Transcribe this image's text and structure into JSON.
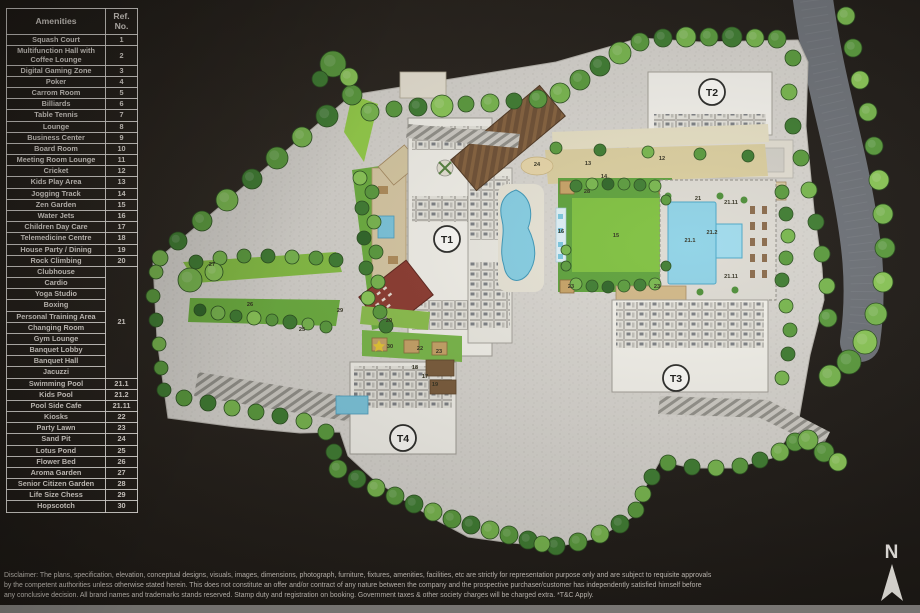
{
  "amenities_table": {
    "headers": [
      "Amenities",
      "Ref. No."
    ],
    "rows": [
      {
        "name": "Squash Court",
        "ref": "1"
      },
      {
        "name": "Multifunction Hall with Coffee Lounge",
        "ref": "2"
      },
      {
        "name": "Digital Gaming Zone",
        "ref": "3"
      },
      {
        "name": "Poker",
        "ref": "4"
      },
      {
        "name": "Carrom Room",
        "ref": "5"
      },
      {
        "name": "Billiards",
        "ref": "6"
      },
      {
        "name": "Table Tennis",
        "ref": "7"
      },
      {
        "name": "Lounge",
        "ref": "8"
      },
      {
        "name": "Business Center",
        "ref": "9"
      },
      {
        "name": "Board Room",
        "ref": "10"
      },
      {
        "name": "Meeting Room Lounge",
        "ref": "11"
      },
      {
        "name": "Cricket",
        "ref": "12"
      },
      {
        "name": "Kids Play Area",
        "ref": "13"
      },
      {
        "name": "Jogging Track",
        "ref": "14"
      },
      {
        "name": "Zen Garden",
        "ref": "15"
      },
      {
        "name": "Water Jets",
        "ref": "16"
      },
      {
        "name": "Children Day Care",
        "ref": "17"
      },
      {
        "name": "Telemedicine Centre",
        "ref": "18"
      },
      {
        "name": "House Party / Dining",
        "ref": "19"
      },
      {
        "name": "Rock Climbing",
        "ref": "20"
      },
      {
        "name": "Clubhouse",
        "ref": "21",
        "group_size": 10
      },
      {
        "name": "Cardio"
      },
      {
        "name": "Yoga Studio"
      },
      {
        "name": "Boxing"
      },
      {
        "name": "Personal Training Area"
      },
      {
        "name": "Changing Room"
      },
      {
        "name": "Gym Lounge"
      },
      {
        "name": "Banquet Lobby"
      },
      {
        "name": "Banquet Hall"
      },
      {
        "name": "Jacuzzi"
      },
      {
        "name": "Swimming Pool",
        "ref": "21.1"
      },
      {
        "name": "Kids Pool",
        "ref": "21.2"
      },
      {
        "name": "Pool Side Cafe",
        "ref": "21.11"
      },
      {
        "name": "Kiosks",
        "ref": "22"
      },
      {
        "name": "Party Lawn",
        "ref": "23"
      },
      {
        "name": "Sand Pit",
        "ref": "24"
      },
      {
        "name": "Lotus Pond",
        "ref": "25"
      },
      {
        "name": "Flower Bed",
        "ref": "26"
      },
      {
        "name": "Aroma Garden",
        "ref": "27"
      },
      {
        "name": "Senior Citizen Garden",
        "ref": "28"
      },
      {
        "name": "Life Size Chess",
        "ref": "29"
      },
      {
        "name": "Hopscotch",
        "ref": "30"
      }
    ]
  },
  "map": {
    "towers": [
      {
        "label": "T1",
        "x": 447,
        "y": 239
      },
      {
        "label": "T2",
        "x": 712,
        "y": 92
      },
      {
        "label": "T3",
        "x": 676,
        "y": 378
      },
      {
        "label": "T4",
        "x": 403,
        "y": 438
      }
    ],
    "ref_labels": [
      {
        "t": "12",
        "x": 662,
        "y": 160
      },
      {
        "t": "13",
        "x": 588,
        "y": 165
      },
      {
        "t": "14",
        "x": 604,
        "y": 178
      },
      {
        "t": "24",
        "x": 537,
        "y": 166
      },
      {
        "t": "28",
        "x": 587,
        "y": 193
      },
      {
        "t": "16",
        "x": 561,
        "y": 233
      },
      {
        "t": "15",
        "x": 616,
        "y": 237
      },
      {
        "t": "23",
        "x": 571,
        "y": 288
      },
      {
        "t": "23",
        "x": 657,
        "y": 288
      },
      {
        "t": "21",
        "x": 698,
        "y": 200
      },
      {
        "t": "21.1",
        "x": 690,
        "y": 242
      },
      {
        "t": "21.2",
        "x": 712,
        "y": 234
      },
      {
        "t": "21.11",
        "x": 731,
        "y": 204
      },
      {
        "t": "21.11",
        "x": 731,
        "y": 278
      },
      {
        "t": "20",
        "x": 389,
        "y": 322
      },
      {
        "t": "30",
        "x": 390,
        "y": 348
      },
      {
        "t": "22",
        "x": 420,
        "y": 350
      },
      {
        "t": "23",
        "x": 439,
        "y": 353
      },
      {
        "t": "18",
        "x": 415,
        "y": 369
      },
      {
        "t": "17",
        "x": 425,
        "y": 378
      },
      {
        "t": "19",
        "x": 435,
        "y": 386
      },
      {
        "t": "27",
        "x": 212,
        "y": 266
      },
      {
        "t": "26",
        "x": 250,
        "y": 306
      },
      {
        "t": "25",
        "x": 302,
        "y": 331
      },
      {
        "t": "29",
        "x": 340,
        "y": 312
      }
    ]
  },
  "disclaimer": {
    "lines": [
      "Disclaimer: The plans, specification, elevation, conceptual designs, visuals, images, dimensions, photograph, furniture, fixtures, amenities, facilities, etc are strictly for representation purpose only and are subject to requisite approvals",
      "by the competent authorities unless otherwise stated herein. This does not constitute an offer and/or contract of any nature between the company and the prospective purchaser/customer has independently satisfied himself before",
      "any conclusive decision. All brand names and trademarks stands reserved. Stamp duty and registration on booking. Government taxes & other society charges will be charged extra. *T&C Apply."
    ]
  },
  "compass": {
    "label": "N"
  },
  "colors": {
    "background": "#26211c",
    "paving": "#d8d5cf",
    "lawn": "#7fc13f",
    "tree_dark": "#3f7d31",
    "tree_mid": "#5b9c3d",
    "tree_light": "#79b84e",
    "pool_blue": "#8ed2e6",
    "road_grey": "#6e7278",
    "deck_tan": "#d8c9a2",
    "roof_brown": "#6e4f33",
    "building_red": "#8d3a2f",
    "building_white": "#f3f1ea",
    "table_line": "#f5f2ee",
    "text_light": "#efe9e2"
  }
}
